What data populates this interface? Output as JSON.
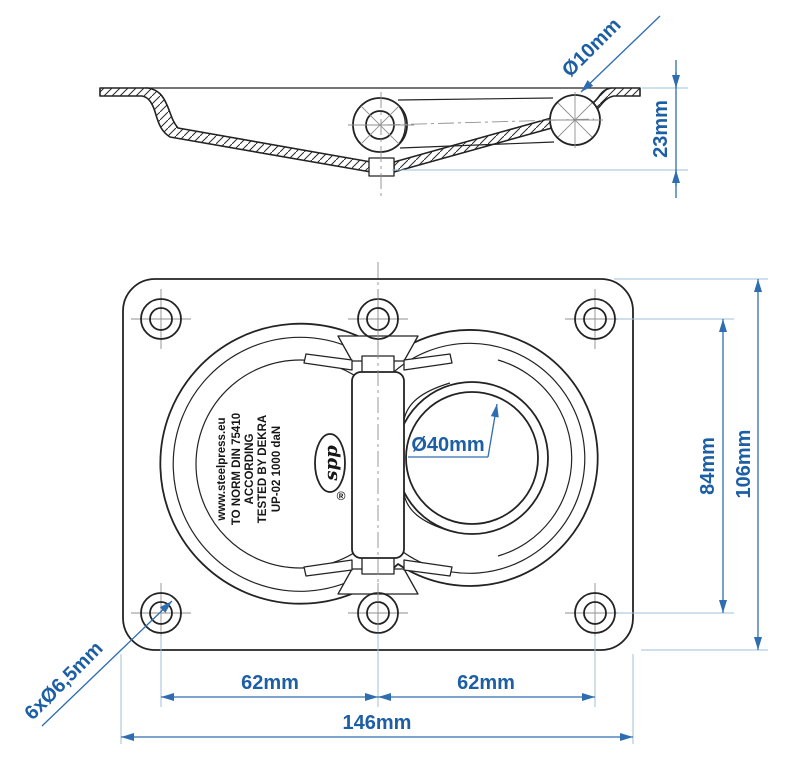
{
  "colors": {
    "drawing_line": "#232323",
    "centerline_gray": "#8f8f8f",
    "dimension_blue": "#2e6daf",
    "label_blue": "#1d5fa5",
    "extension_light_blue": "#9ec2de",
    "background": "#ffffff"
  },
  "side_view": {
    "labels": {
      "pin_diameter": "Ø10mm",
      "recess_depth": "23mm"
    }
  },
  "front_view": {
    "labels": {
      "ring_opening": "Ø40mm",
      "hole_pitch_left": "62mm",
      "hole_pitch_right": "62mm",
      "overall_width": "146mm",
      "hole_pitch_vertical": "84mm",
      "overall_height": "106mm",
      "mounting_holes": "6xØ6,5mm"
    },
    "ring_marking": {
      "lines": [
        "UP-02 1000 daN",
        "TESTED BY DEKRA",
        "ACCORDING",
        "TO NORM DIN 75410",
        "www.steelpress.eu"
      ]
    },
    "logo": {
      "text": "spp",
      "registered_mark": "®"
    }
  }
}
